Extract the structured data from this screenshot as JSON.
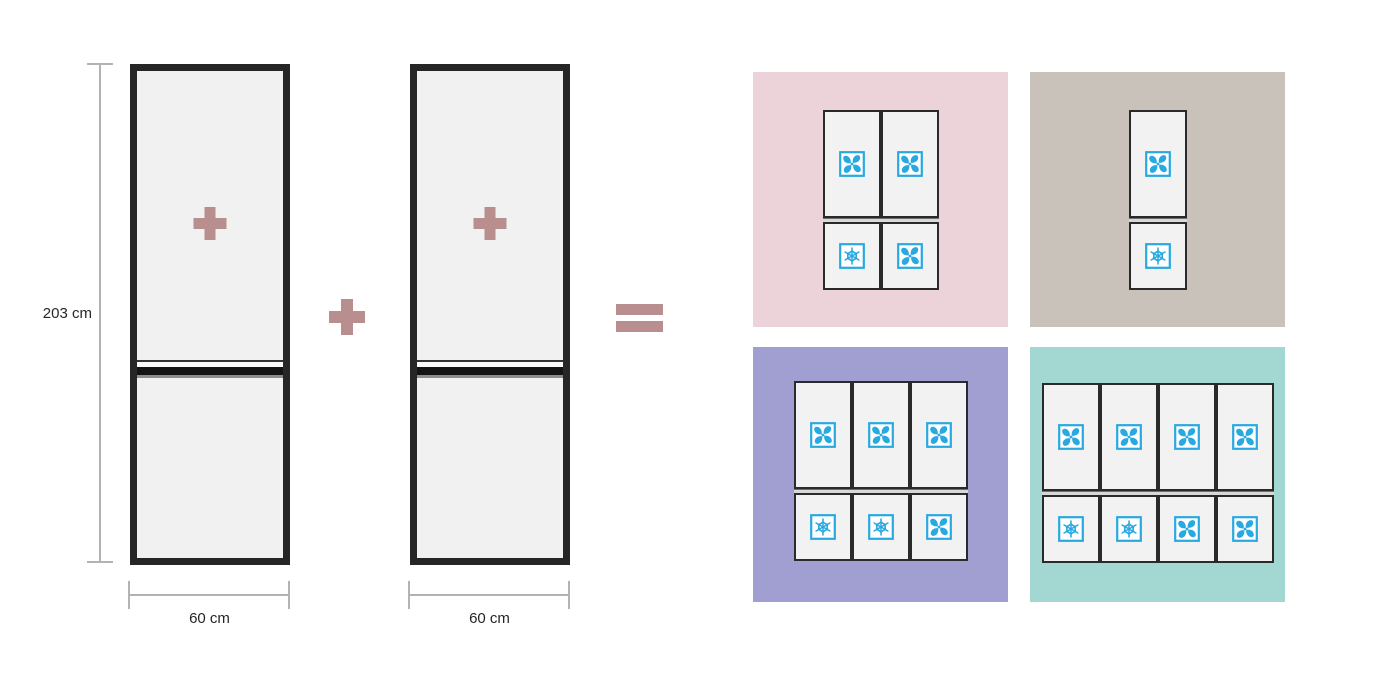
{
  "colors": {
    "operator": "#b98e8e",
    "icon_blue": "#29a9e0",
    "fridge_fill": "#f1f1f1",
    "fridge_border": "#262626",
    "dimension_line": "#b3b3b3",
    "panel_pink": "#ecd3d9",
    "panel_taupe": "#c8c2bb",
    "panel_purple": "#a19ed1",
    "panel_teal": "#a3d8d2"
  },
  "dimensions": {
    "height_label": "203 cm",
    "width_label_left": "60 cm",
    "width_label_right": "60 cm"
  },
  "operators": {
    "between_fridges": "plus",
    "result": "equals"
  },
  "fridges": [
    {
      "badge": "plus"
    },
    {
      "badge": "plus"
    }
  ],
  "panels": [
    {
      "name": "two-column-combination",
      "bg": "#ecd3d9",
      "columns": [
        {
          "top": "fan",
          "bottom": "snowflake"
        },
        {
          "top": "fan",
          "bottom": "fan"
        }
      ]
    },
    {
      "name": "one-column-combination",
      "bg": "#c8c2bb",
      "columns": [
        {
          "top": "fan",
          "bottom": "snowflake"
        }
      ]
    },
    {
      "name": "three-column-combination",
      "bg": "#a19ed1",
      "columns": [
        {
          "top": "fan",
          "bottom": "snowflake"
        },
        {
          "top": "fan",
          "bottom": "snowflake"
        },
        {
          "top": "fan",
          "bottom": "fan"
        }
      ]
    },
    {
      "name": "four-column-combination",
      "bg": "#a3d8d2",
      "columns": [
        {
          "top": "fan",
          "bottom": "snowflake"
        },
        {
          "top": "fan",
          "bottom": "snowflake"
        },
        {
          "top": "fan",
          "bottom": "fan"
        },
        {
          "top": "fan",
          "bottom": "fan"
        }
      ]
    }
  ]
}
